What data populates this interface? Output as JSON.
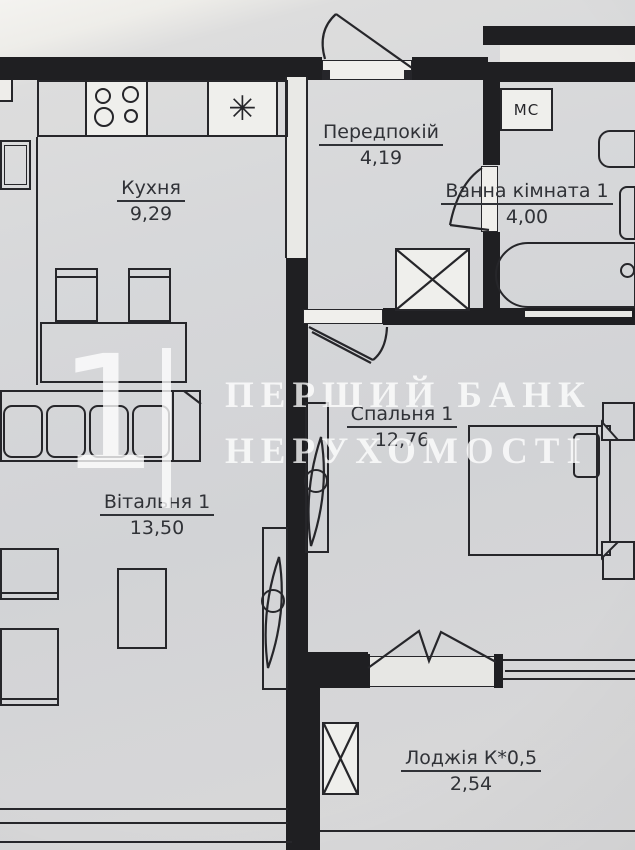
{
  "document": {
    "title": "Apartment floor plan (1-bedroom)",
    "language": "uk"
  },
  "rooms": [
    {
      "id": "kitchen",
      "name": "Кухня",
      "area": "9,29"
    },
    {
      "id": "hallway",
      "name": "Передпокій",
      "area": "4,19"
    },
    {
      "id": "bathroom",
      "name": "Ванна кімната 1",
      "area": "4,00"
    },
    {
      "id": "bedroom",
      "name": "Спальня 1",
      "area": "12,76"
    },
    {
      "id": "living_room",
      "name": "Вітальня 1",
      "area": "13,50"
    },
    {
      "id": "loggia",
      "name": "Лоджія К*0,5",
      "area": "2,54"
    }
  ],
  "labels": {
    "washing_machine": "МС"
  },
  "symbols": {
    "sink_asterisk": "✳"
  },
  "watermark": {
    "numeral": "1",
    "line1": "ПЕРШИЙ БАНК",
    "line2": "НЕРУХОМОСТІ"
  },
  "colors": {
    "wall": "#1f1f22",
    "line": "#26262a",
    "paper": "#d6d7d9",
    "paper_light": "#f3f2ef",
    "fixture_white": "#efefec",
    "text": "#303237",
    "watermark_white": "rgba(255,255,255,0.78)"
  }
}
